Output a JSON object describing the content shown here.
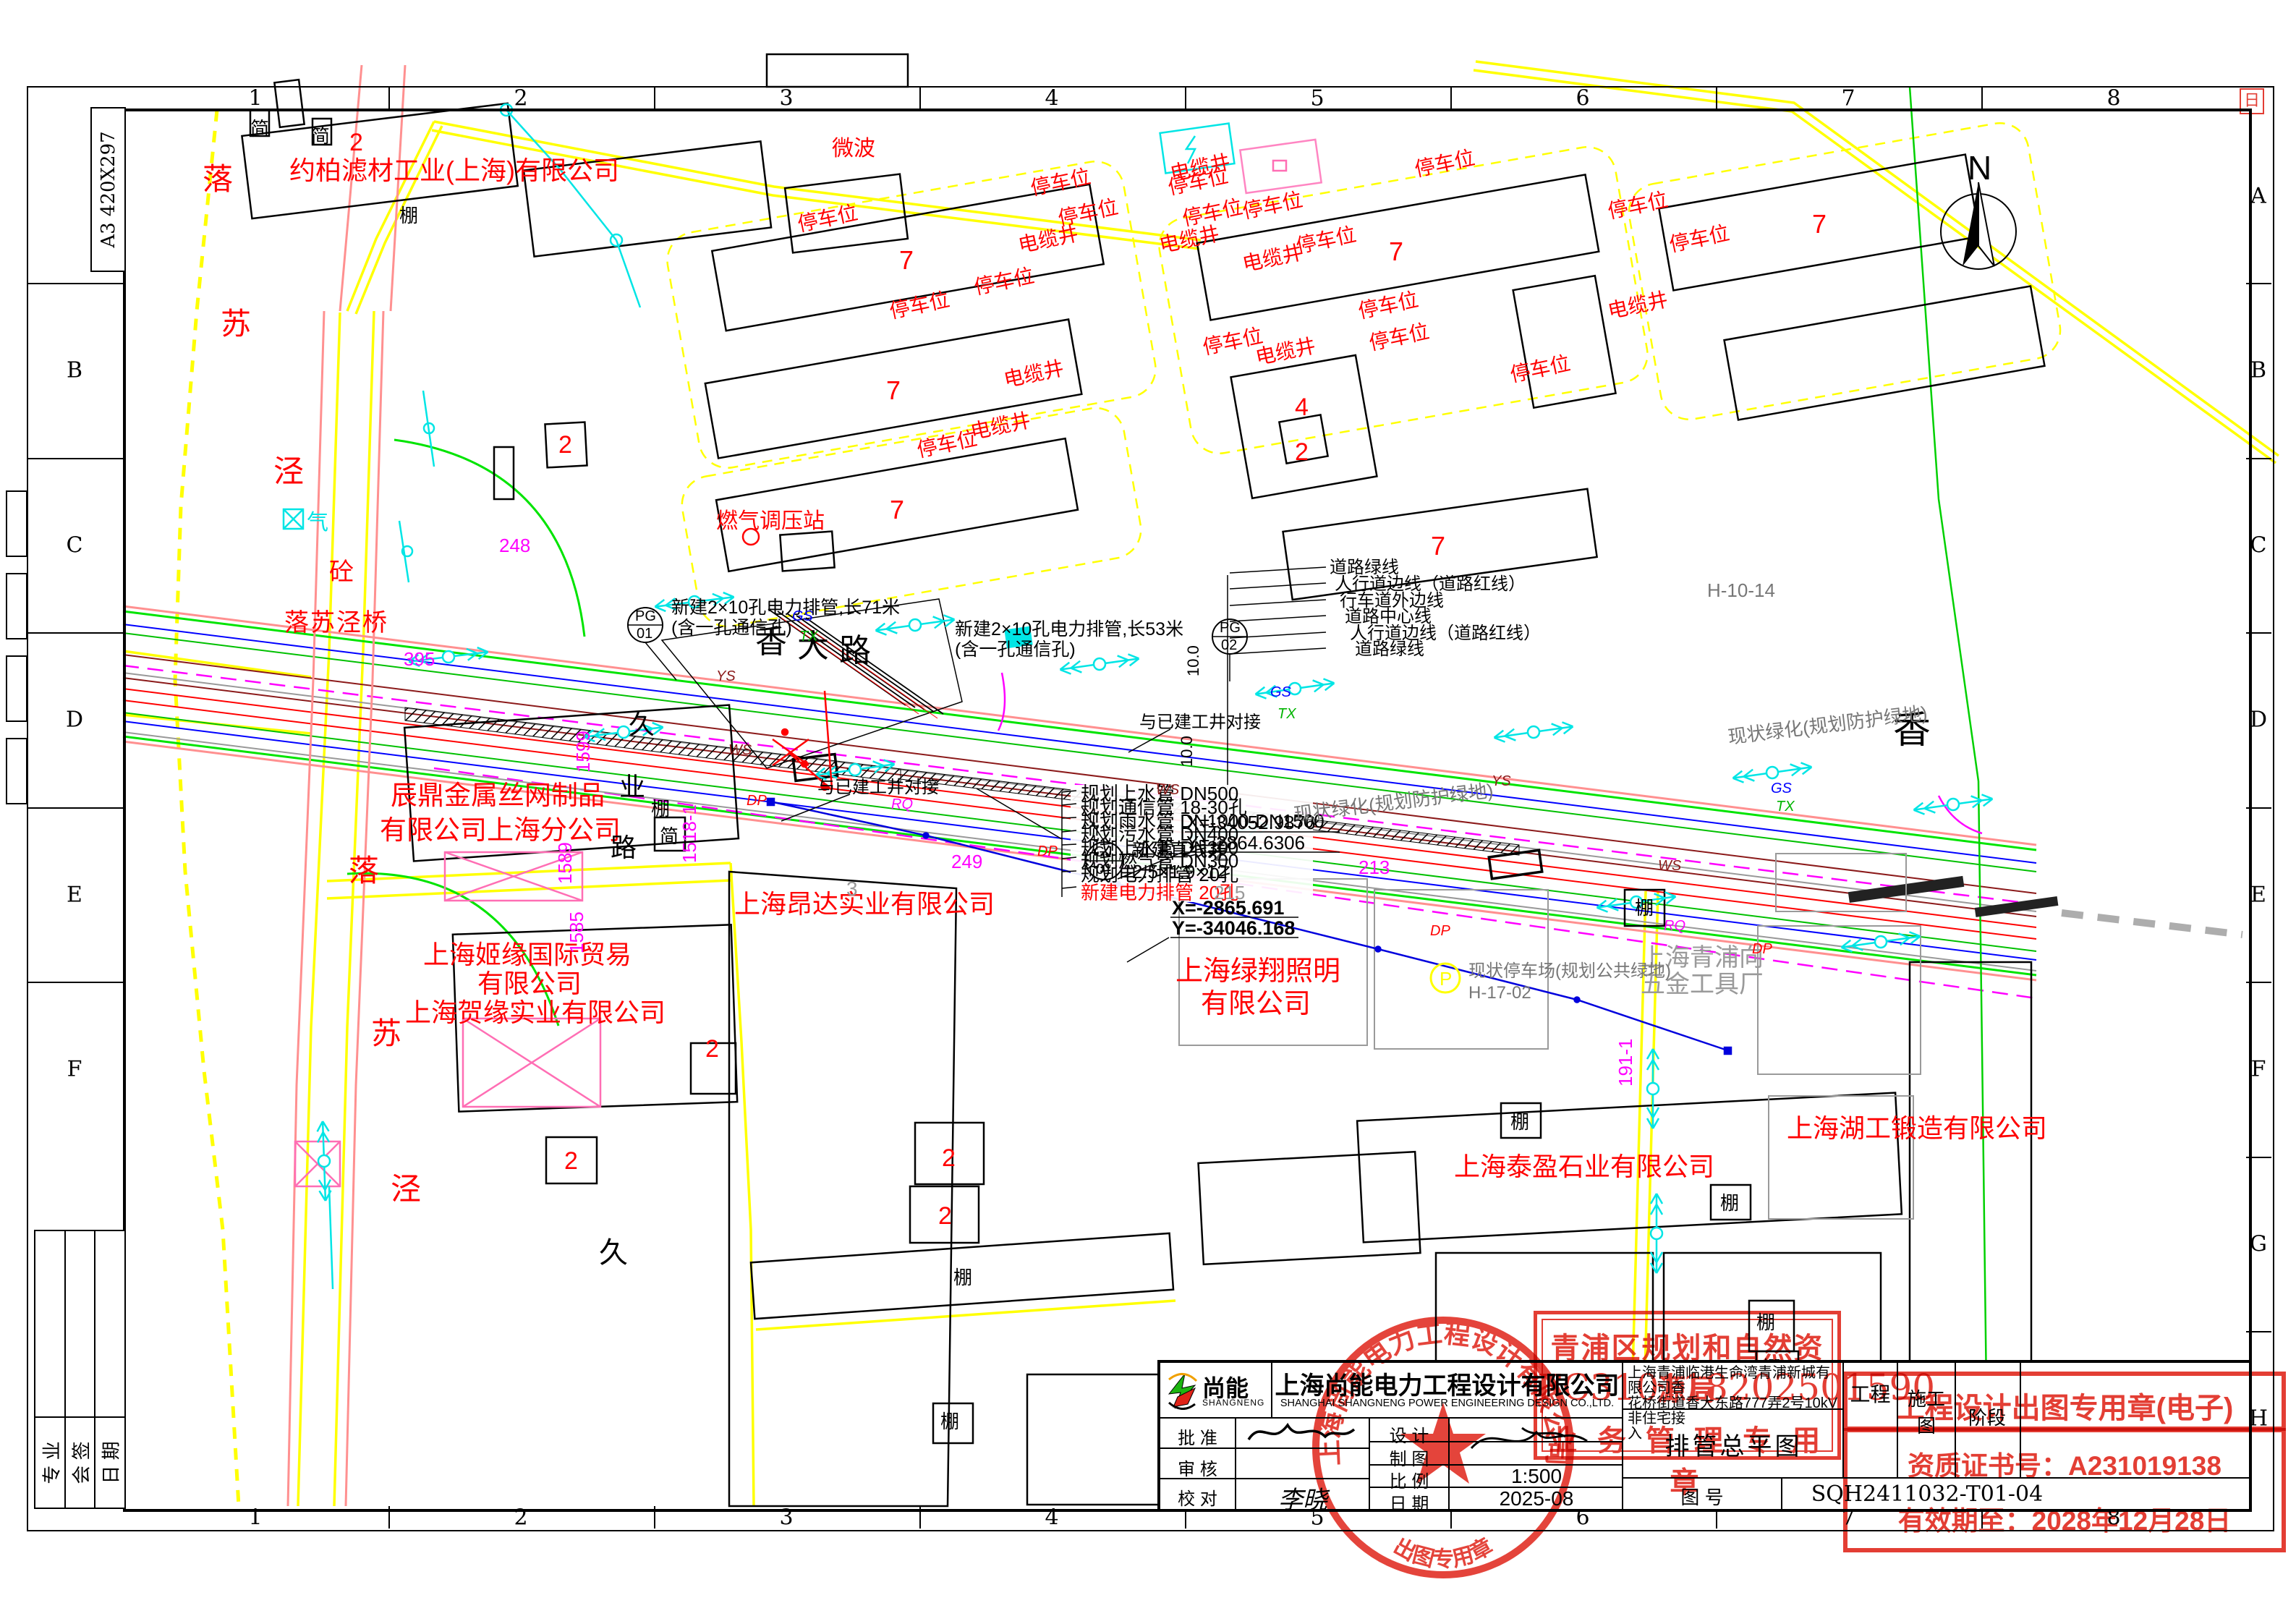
{
  "frame": {
    "size_label": "A3 420X297",
    "cols": [
      "1",
      "2",
      "3",
      "4",
      "5",
      "6",
      "7",
      "8"
    ],
    "rows": [
      "A",
      "B",
      "C",
      "D",
      "E",
      "F",
      "G",
      "H"
    ]
  },
  "signoff": {
    "col1": "专 业",
    "col2": "会 签",
    "col3": "日 期"
  },
  "compass": {
    "n": "N"
  },
  "map": {
    "chars": {
      "luo": "落",
      "su": "苏",
      "jing": "泾",
      "jiu": "久",
      "ye": "业",
      "lu": "路",
      "xiang": "香",
      "da": "大",
      "qi": "气",
      "tong": "砼",
      "peng": "棚",
      "jian": "简",
      "n2": "2",
      "n3": "3",
      "n4": "4",
      "n7": "7",
      "g2": "2"
    },
    "bridge": "落苏泾桥",
    "companies": {
      "yuebai": "约柏滤材工业(上海)有限公司",
      "chending1": "辰鼎金属丝网制品",
      "chending2": "有限公司上海分公司",
      "jiyuan1": "上海姬缘国际贸易",
      "jiyuan2": "有限公司",
      "heyuan": "上海贺缘实业有限公司",
      "angda": "上海昂达实业有限公司",
      "lvxiang1": "上海绿翔照明",
      "lvxiang2": "有限公司",
      "taiying": "上海泰盈石业有限公司",
      "hugong": "上海湖工锻造有限公司",
      "wujin1": "上海青浦向",
      "wujin2": "五金工具厂"
    },
    "labels": {
      "parking": "停车位",
      "cable_well": "电缆井",
      "microwave": "微波",
      "gas_station": "燃气调压站",
      "green_existing": "现状绿化(规划防护绿地)",
      "parking_lot": "现状停车场(规划公共绿地)",
      "parking_lot_code": "H-17-02",
      "block_code": "H-10-14",
      "connect": "与已建工井对接"
    },
    "callouts": {
      "pg": "PG",
      "gj": "GJ",
      "c01": "01",
      "c02": "02",
      "pg01_l1": "新建2×10孔电力排管,长71米",
      "pg01_l2": "(含一孔通信孔)",
      "pg02_l1": "新建2×10孔电力排管,长53米",
      "pg02_l2": "(含一孔通信孔)",
      "well": "新建直线井",
      "well_size": "2.5×1.9×12",
      "coord1x": "X=-34052.9876",
      "coord1y": "Y=-2864.6306",
      "coord2x": "X=-2865.691",
      "coord2y": "Y=-34046.168",
      "dim10": "10.0"
    },
    "pipe_list": [
      "规划上水管 DN500",
      "规划通信管 18-30孔",
      "规划雨水管 DN1000-DN1500",
      "规划污水管 DN400",
      "规划上水管 DN300",
      "规划燃气管 DN300",
      "规划电力排管 20孔"
    ],
    "pipe_new": "新建电力排管 20孔",
    "road_lines": [
      "道路绿线",
      "人行道边线（道路红线）",
      "行车道外边线",
      "道路中心线",
      "人行道边线（道路红线）",
      "道路绿线"
    ],
    "line_codes": {
      "gs": "GS",
      "tx": "TX",
      "ys": "YS",
      "ws": "WS",
      "dp": "DP",
      "rq": "RQ",
      "p": "P"
    },
    "nums": {
      "n1599": "1599",
      "n1589": "1589",
      "n1585": "1585",
      "n1518": "1518-1",
      "n248": "248",
      "n395": "395",
      "n213": "213",
      "n249": "249",
      "n191": "191-1",
      "n215": "215"
    }
  },
  "titleblock": {
    "logo_text": "尚能",
    "logo_sub": "SHANGNENG",
    "company_cn": "上海尚能电力工程设计有限公司",
    "company_en": "SHANGHAI SHANGNENG POWER ENGINEERING DESIGN CO.,LTD.",
    "approve_label": "批  准",
    "review_label": "审  核",
    "check_label": "校  对",
    "design_label": "设  计",
    "draft_label": "制  图",
    "scale_label": "比  例",
    "scale_value": "1:500",
    "date_label": "日  期",
    "date_value": "2025-08",
    "no_label": "图  号",
    "no_value": "SQH2411032-T01-04",
    "project_line1": "上海青浦临港生命湾青浦新城有限公司香",
    "project_line2": "花桥街道香大东路777弄2号10kV非住宅接",
    "project_line3": "入",
    "project_suffix": "工程",
    "stage_value1": "施工",
    "stage_value2": "图",
    "stage_label": "阶段",
    "drawing_title": "排管总平图",
    "sig_check": "李晓"
  },
  "stamps": {
    "bureau_line1": "青浦区规划和自然资源局",
    "bureau_code": "FC310118202501590",
    "bureau_line3": "业 务 管 理 专 用 章",
    "eseal_text": "工程设计出图专用章(电子)",
    "cert_text": "资质证书号：A231019138",
    "validity_text": "有效期至：2028年12月28日",
    "circle_top": "上海尚能电力工程设计有限公司",
    "circle_bottom": "出图专用章",
    "corner_mark": "日"
  }
}
